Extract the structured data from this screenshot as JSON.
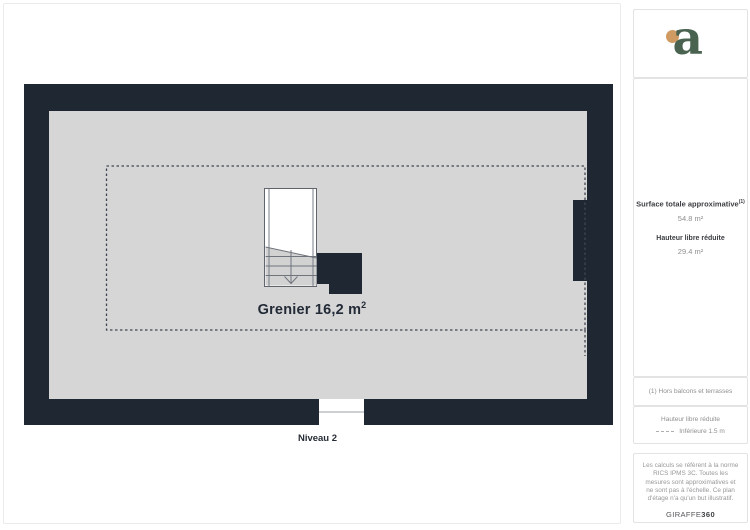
{
  "plan": {
    "room_label": "Grenier 16,2 m",
    "room_label_exp": "2",
    "level_label": "Niveau 2"
  },
  "sidebar": {
    "logo_letter": "a",
    "summary": {
      "title": "Surface totale approximative",
      "title_sup": "(1)",
      "total_value": "54.8 m²",
      "reduced_title": "Hauteur libre réduite",
      "reduced_value": "29.4 m²"
    },
    "footnote": "(1) Hors balcons et terrasses",
    "legend": {
      "title": "Hauteur libre réduite",
      "item_label": "Inférieure 1.5 m"
    },
    "legal_text": "Les calculs se réfèrent à la norme RICS IPMS 3C. Toutes les mesures sont approximatives et ne sont pas à l'échelle. Ce plan d'étage n'a qu'un but illustratif.",
    "brand_name": "GIRAFFE",
    "brand_suffix": "360"
  },
  "colors": {
    "wall": "#1f2733",
    "floor": "#d6d6d7",
    "logo_green": "#4a6250",
    "logo_orange": "#cf9b62"
  }
}
